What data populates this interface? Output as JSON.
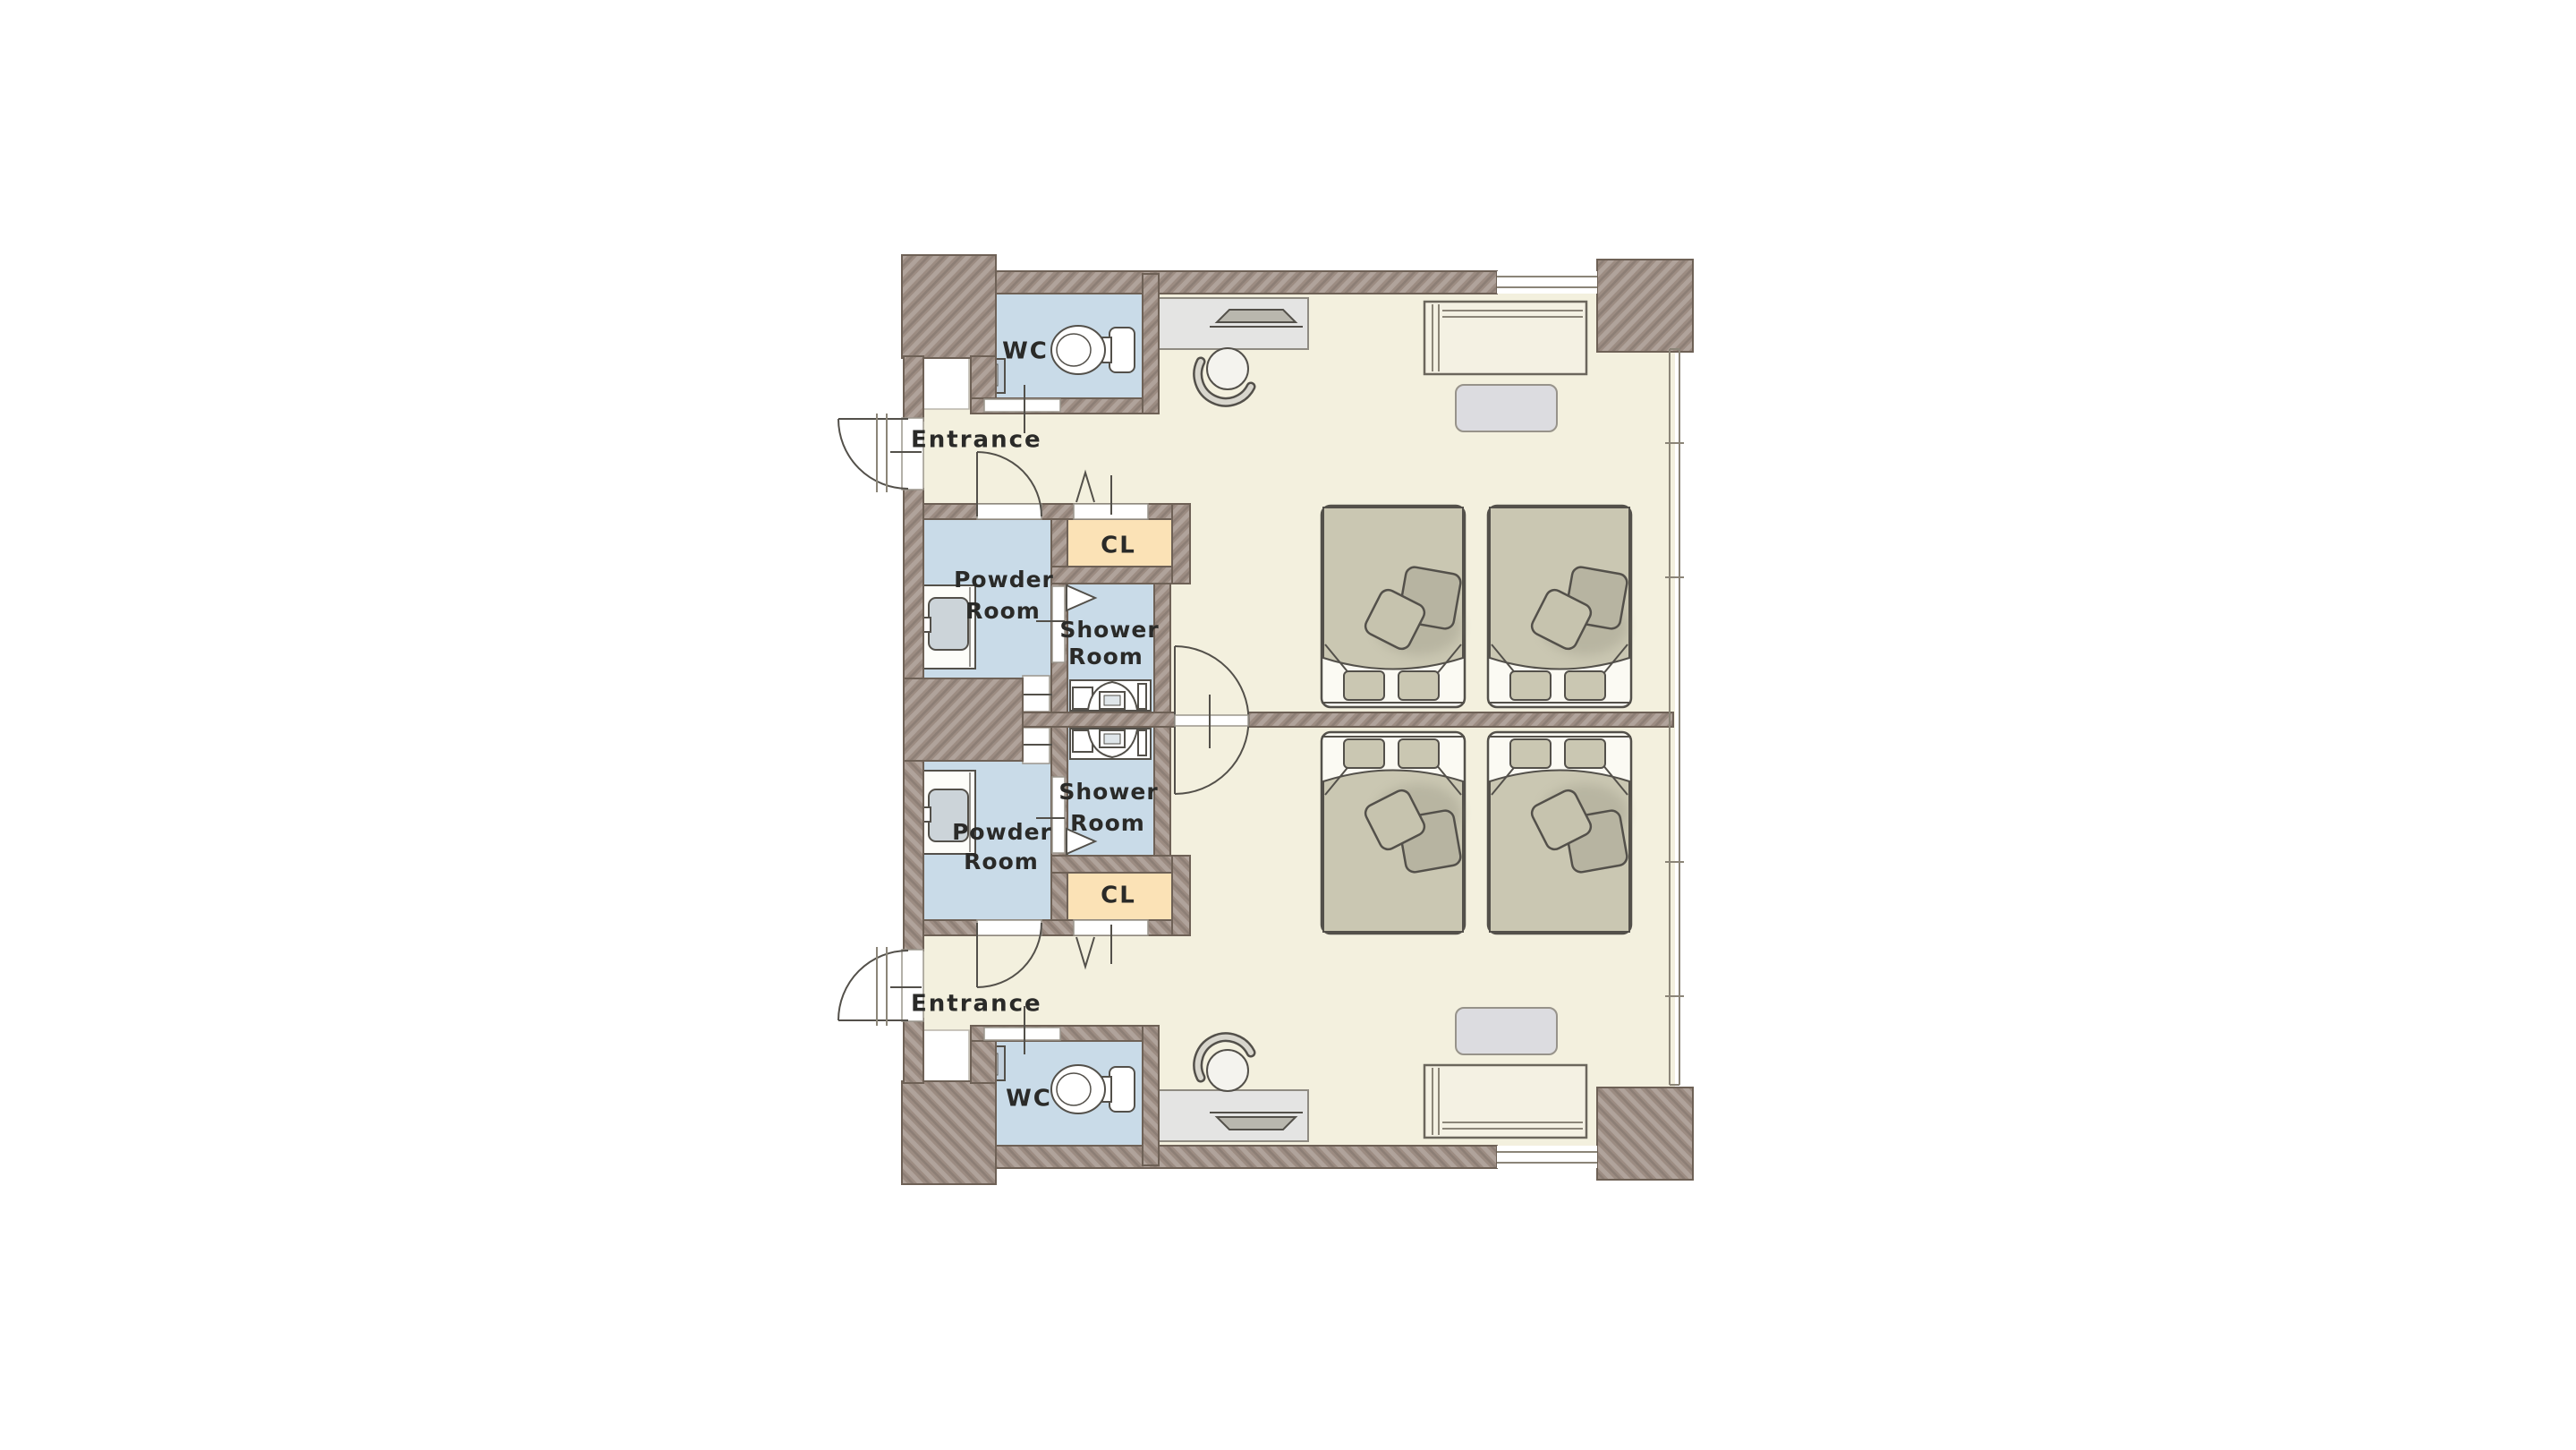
{
  "figure_type": "floor-plan",
  "page": {
    "background": "#ffffff"
  },
  "labels": {
    "entrance": "Entrance",
    "wc": "WC",
    "powder_room": [
      "Powder",
      "Room"
    ],
    "shower_room": [
      "Shower",
      "Room"
    ],
    "closet": "CL"
  },
  "colors": {
    "background": "#ffffff",
    "wall": "#9c8c82",
    "wall_outline": "#6e6156",
    "floor": "#f3f0de",
    "wet_area": "#c9dbe8",
    "closet": "#fbe2b6",
    "bed": "#cac7b2",
    "cushion_dark": "#b7b4a1",
    "cushion_light": "#c6c3ae",
    "furniture": "#e4e4e3",
    "side_table": "#dcdce0",
    "bench": "#f4f1e3",
    "line": "#53504a",
    "window_line": "#8b8578",
    "label": "#2a2a28"
  },
  "fixtures": [
    "toilet",
    "hand-basin",
    "vanity-sink",
    "shower-unit",
    "closet",
    "entrance-door",
    "interior-door",
    "folding-door",
    "connecting-double-door",
    "window",
    "desk",
    "monitor",
    "office-chair",
    "twin-bed",
    "bed-cushions",
    "bench-sofa",
    "side-table"
  ]
}
